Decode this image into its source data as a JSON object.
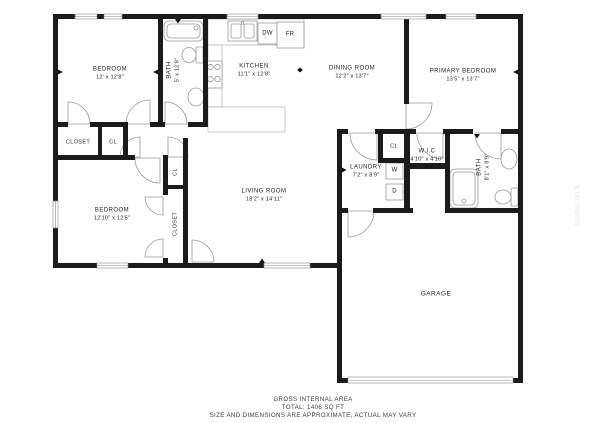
{
  "rooms": {
    "bedroom1": {
      "name": "BEDROOM",
      "dims": "12' x 12'8\""
    },
    "bath1": {
      "name": "BATH",
      "dims": "5' x 12'8\""
    },
    "kitchen": {
      "name": "KITCHEN",
      "dims": "11'1\" x 12'8\""
    },
    "dining_room": {
      "name": "DINING ROOM",
      "dims": "12'2\" x 13'7\""
    },
    "primary_bedroom": {
      "name": "PRIMARY BEDROOM",
      "dims": "13'5\" x 13'7\""
    },
    "bedroom2": {
      "name": "BEDROOM",
      "dims": "12'10\" x 12'5\""
    },
    "living_room": {
      "name": "LIVING ROOM",
      "dims": "18'2\" x 14'11\""
    },
    "laundry": {
      "name": "LAUNDRY",
      "dims": "7'2\" x 8'9\""
    },
    "wic": {
      "name": "W.I.C",
      "dims": "4'10\" x 4'10\""
    },
    "bath2": {
      "name": "BATH",
      "dims": "8'1\" x 8'9\""
    },
    "garage": {
      "name": "GARAGE"
    },
    "closet1": {
      "name": "CLOSET"
    },
    "cl1": {
      "name": "CL"
    },
    "cl2": {
      "name": "CL"
    },
    "closet2": {
      "name": "CLOSET"
    },
    "cl3": {
      "name": "CL"
    }
  },
  "appliances": {
    "dishwasher": "DW",
    "fridge": "FR",
    "washer": "W",
    "dryer": "D"
  },
  "footer": {
    "line1": "GROSS INTERNAL AREA",
    "line2": "TOTAL: 1406 SQ FT",
    "line3": "SIZE AND DIMENSIONS ARE APPROXIMATE, ACTUAL MAY VARY"
  },
  "watermark": "Stellar MLS",
  "colors": {
    "wall": "#1b1b1b",
    "fixture": "#9a9a9a",
    "background": "#ffffff"
  }
}
